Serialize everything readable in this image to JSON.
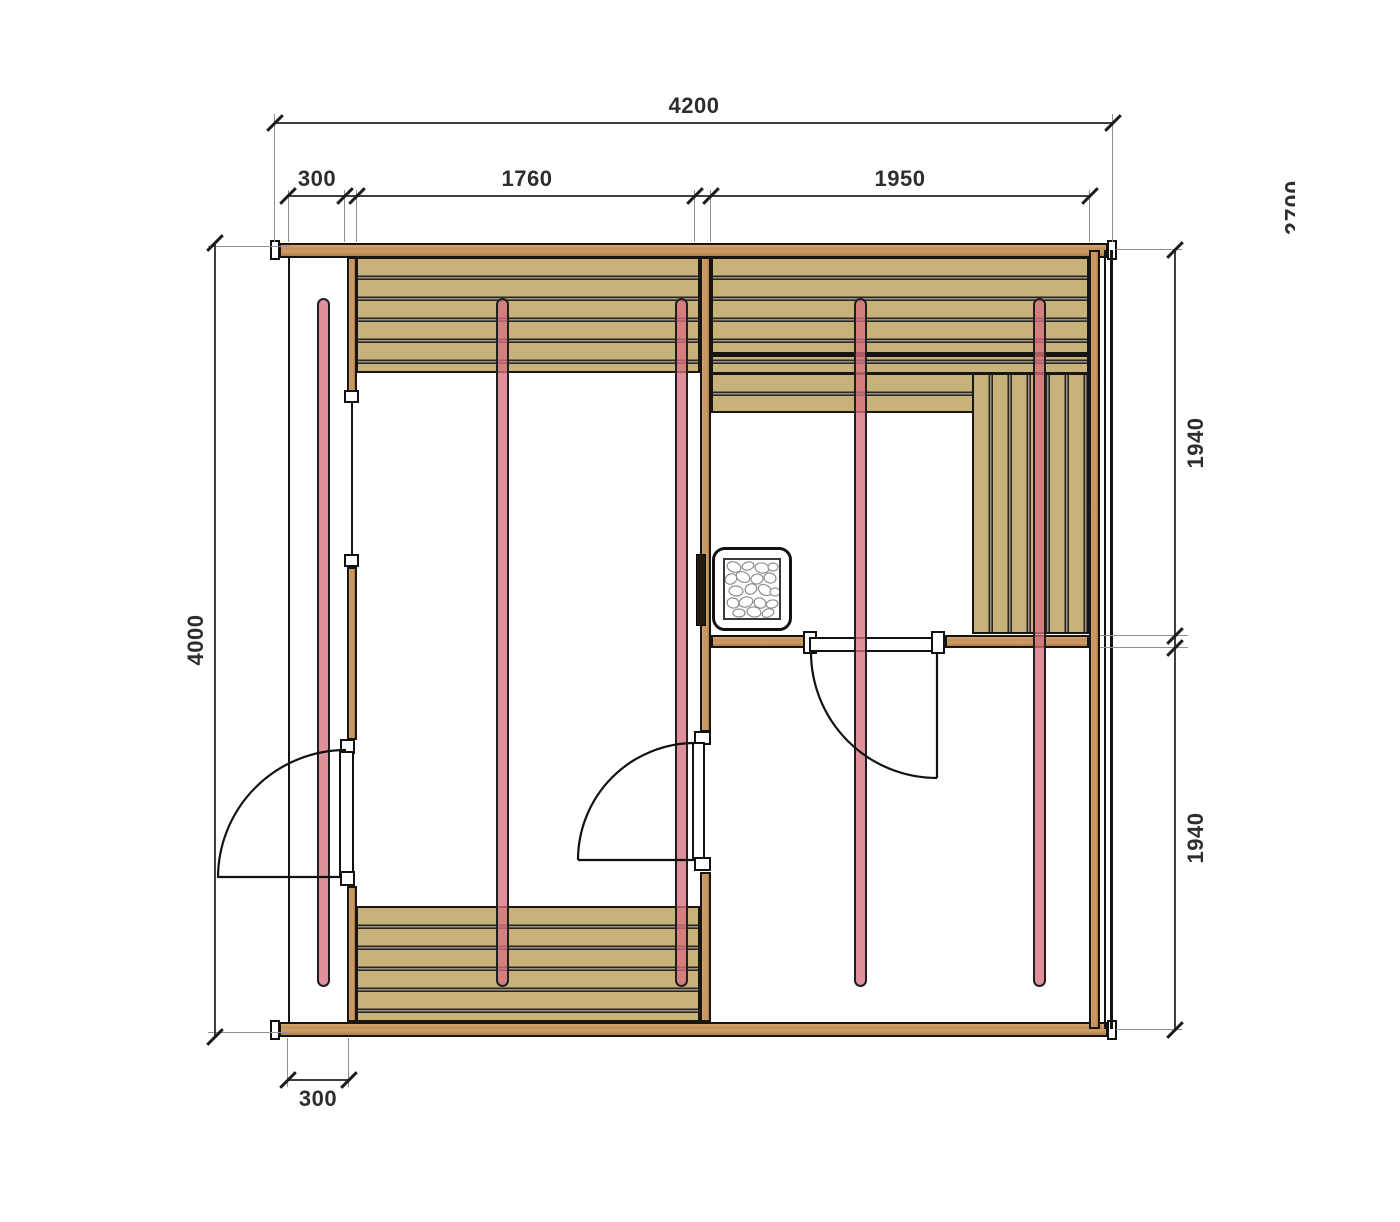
{
  "drawing": {
    "type": "sauna-floor-plan",
    "dimensions": {
      "total_width": "4200",
      "seg_left_offset": "300",
      "seg_room_left": "1760",
      "seg_room_right": "1950",
      "total_depth": "4000",
      "right_upper": "1940",
      "right_lower": "1940",
      "clipped_side": "2700",
      "bottom_offset": "300"
    },
    "colors": {
      "wood": "#c2905a",
      "bench": "#c7b37a",
      "glass_panel": "#e29aa4",
      "outline": "#1a1a1a",
      "dimension_line": "#3f3f3f"
    }
  }
}
